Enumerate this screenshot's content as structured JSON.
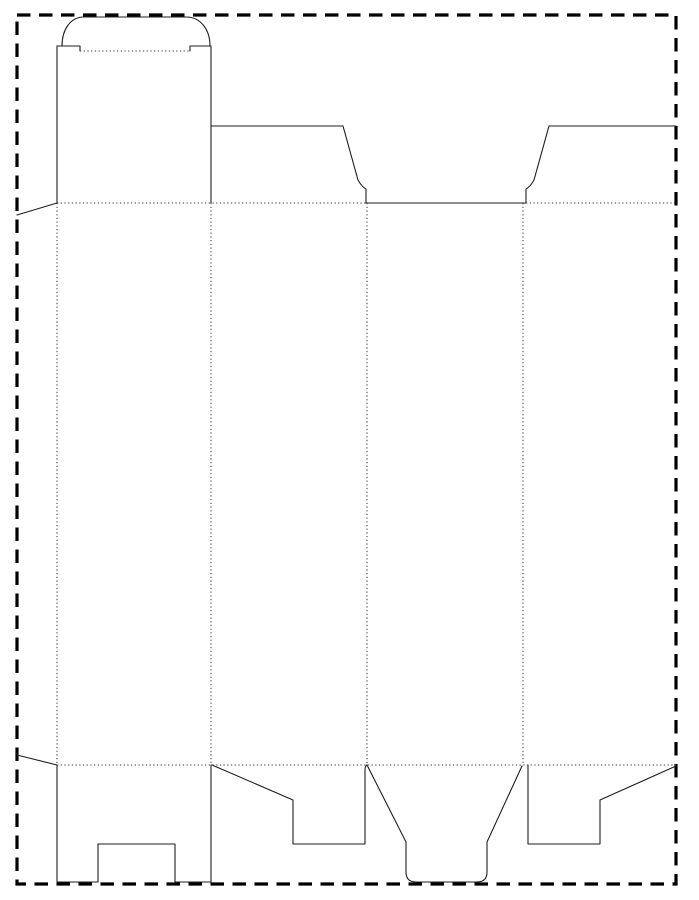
{
  "canvas": {
    "width": 699,
    "height": 900,
    "background": "#ffffff"
  },
  "drawing": {
    "colors": {
      "cut": "#1f1f1f",
      "fold": "#3a3a3a",
      "border": "#000000"
    },
    "line_styles": {
      "cut": {
        "stroke_width": 1.1,
        "dash": ""
      },
      "fold": {
        "stroke_width": 1.0,
        "dash": "1.3 2.4"
      },
      "border": {
        "stroke_width": 3.2,
        "dash": "13.5 8.5"
      }
    },
    "sheet_border": {
      "x": 17,
      "y": 15,
      "width": 659,
      "height": 869
    },
    "cut_paths": [
      {
        "name": "tuck-lid-dome",
        "d": "M 62 46 C 62 30 70 17 84 17 L 186 17 C 201 17 210 30 210 46"
      },
      {
        "name": "tuck-shoulder-left",
        "d": "M 57 46 L 80 46 L 80 51"
      },
      {
        "name": "tuck-shoulder-right",
        "d": "M 190 51 L 190 46 L 211 46"
      },
      {
        "name": "panel1-left-edge",
        "d": "M 57 46 L 57 203"
      },
      {
        "name": "panel1-right-edge",
        "d": "M 211 46 L 211 203"
      },
      {
        "name": "glue-flap-top-cut",
        "d": "M 57 203 L 17 215"
      },
      {
        "name": "panel2-top-flap",
        "d": "M 211 126 L 343 126 L 358 180 Q 362 187 366 189 L 366 203"
      },
      {
        "name": "top-opening-cut",
        "d": "M 366 203 L 526 203"
      },
      {
        "name": "panel4-top-flap",
        "d": "M 526 203 L 526 189 Q 530 187 534 180 L 549 126 L 676 126"
      },
      {
        "name": "glue-flap-bottom-cut",
        "d": "M 17 755 L 57 765"
      },
      {
        "name": "panel1-bottom-flap-left",
        "d": "M 57 765 L 57 882"
      },
      {
        "name": "panel1-bottom-flap-right",
        "d": "M 211 765 L 211 882"
      },
      {
        "name": "panel1-bottom-edge-left",
        "d": "M 57 882 L 98 882"
      },
      {
        "name": "panel1-bottom-edge-right",
        "d": "M 175 882 L 211 882"
      },
      {
        "name": "panel1-bottom-notch",
        "d": "M 98 882 L 98 844 L 175 844 L 175 882"
      },
      {
        "name": "panel2-bottom-flap",
        "d": "M 212 765 L 293 800 L 293 844 L 365 844 L 365 770 Q 365 766 367 765"
      },
      {
        "name": "panel3-bottom-lock",
        "d": "M 367 765 L 406 842 L 406 872 Q 406 882 416 882 L 477 882 Q 487 882 487 872 L 487 842 L 522 766"
      },
      {
        "name": "panel4-bottom-flap",
        "d": "M 528 765 L 528 844 L 600 844 L 600 800 L 676 766"
      }
    ],
    "fold_paths": [
      {
        "name": "tuck-lid-fold",
        "d": "M 80 51 L 190 51"
      },
      {
        "name": "top-fold-left",
        "d": "M 57 203 L 366 203"
      },
      {
        "name": "top-fold-right",
        "d": "M 526 203 L 676 203"
      },
      {
        "name": "bottom-fold",
        "d": "M 57 765 L 676 765"
      },
      {
        "name": "glue-flap-fold",
        "d": "M 57 203 L 57 765"
      },
      {
        "name": "panel1-panel2-fold",
        "d": "M 211 203 L 211 765"
      },
      {
        "name": "panel2-panel3-fold",
        "d": "M 367 203 L 367 765"
      },
      {
        "name": "panel3-panel4-fold",
        "d": "M 523 203 L 523 765"
      }
    ]
  }
}
